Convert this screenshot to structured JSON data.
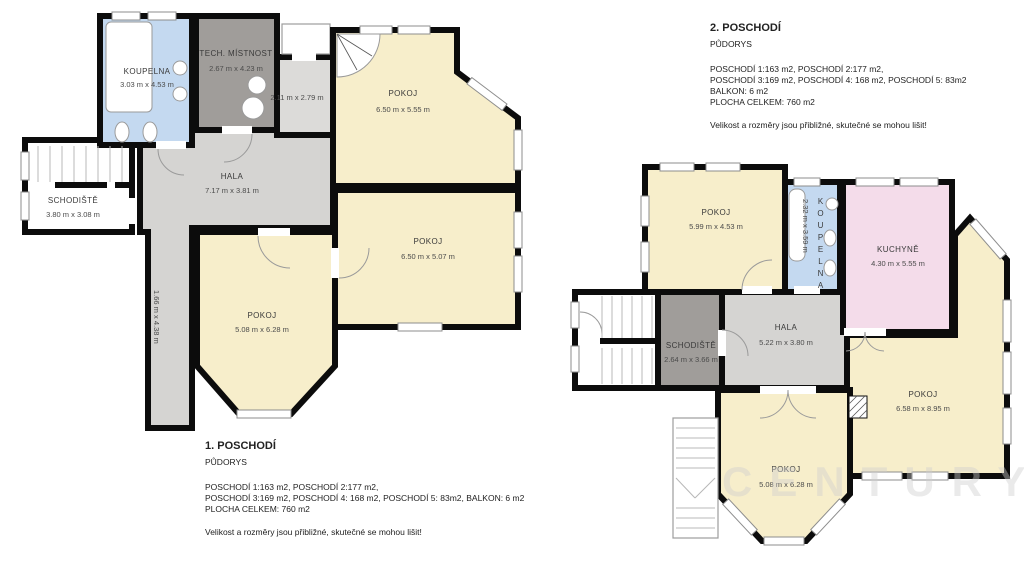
{
  "palette": {
    "room_cream": "#f7eecb",
    "hala_gray": "#d5d4d2",
    "dark_gray": "#a09d9a",
    "small_gray": "#dcdbd9",
    "bath_blue": "#c4d9f0",
    "kitchen_pink": "#f4dcea",
    "wall_black": "#0c0c0c",
    "watermark_gray": "#cfcfcf"
  },
  "watermark": "CENTURY 21",
  "floor1": {
    "title": "1. POSCHODÍ",
    "subtitle": "PŮDORYS",
    "info_line1": "POSCHODÍ 1:163 m2, POSCHODÍ 2:177 m2,",
    "info_line2": "POSCHODÍ 3:169 m2, POSCHODÍ 4: 168 m2, POSCHODÍ 5: 83m2, BALKON: 6 m2",
    "info_line3": "PLOCHA CELKEM: 760 m2",
    "disclaimer": "Velikost a rozměry jsou přibližné, skutečné se mohou lišit!",
    "rooms": {
      "koupelna": {
        "name": "KOUPELNA",
        "dims": "3.03 m x 4.53 m"
      },
      "tech": {
        "name": "TECH. MÍSTNOST",
        "dims": "2.67 m x 4.23 m"
      },
      "small": {
        "dims": "2.11 m x 2.79 m"
      },
      "pokoj_top": {
        "name": "POKOJ",
        "dims": "6.50 m x 5.55 m"
      },
      "pokoj_mid": {
        "name": "POKOJ",
        "dims": "6.50 m x 5.07 m"
      },
      "hala": {
        "name": "HALA",
        "dims": "7.17 m x 3.81 m"
      },
      "schodiste": {
        "name": "SCHODIŠTĚ",
        "dims": "3.80 m x 3.08 m"
      },
      "pokoj_bay": {
        "name": "POKOJ",
        "dims": "5.08 m x 6.28 m"
      },
      "corridor": {
        "dims": "1.66 m x 4.38 m"
      }
    }
  },
  "floor2": {
    "title": "2. POSCHODÍ",
    "subtitle": "PŮDORYS",
    "info_line1": "POSCHODÍ 1:163 m2, POSCHODÍ 2:177 m2,",
    "info_line2": "POSCHODÍ 3:169 m2, POSCHODÍ 4: 168 m2, POSCHODÍ 5: 83m2",
    "info_line3": "BALKON: 6 m2",
    "info_line4": "PLOCHA CELKEM: 760 m2",
    "disclaimer": "Velikost a rozměry jsou přibližné, skutečné se mohou lišit!",
    "rooms": {
      "pokoj_tl": {
        "name": "POKOJ",
        "dims": "5.99 m x 4.53 m"
      },
      "koupelna": {
        "name": "KOUPELNA",
        "dims": "2.32 m x 3.59 m"
      },
      "kuchyne": {
        "name": "KUCHYNĚ",
        "dims": "4.30 m x 5.55 m"
      },
      "schodiste": {
        "name": "SCHODIŠTĚ",
        "dims": "2.64 m x 3.66 m"
      },
      "hala": {
        "name": "HALA",
        "dims": "5.22 m x 3.80 m"
      },
      "pokoj_right": {
        "name": "POKOJ",
        "dims": "6.58 m x 8.95 m"
      },
      "pokoj_bay": {
        "name": "POKOJ",
        "dims": "5.08 m x 6.28 m"
      }
    }
  }
}
